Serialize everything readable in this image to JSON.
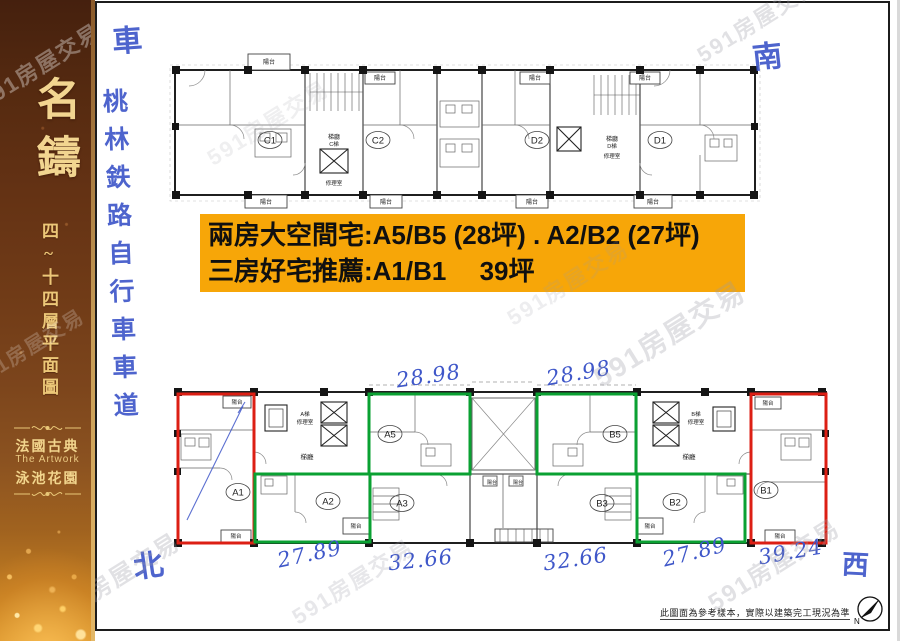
{
  "colors": {
    "orange": "#F7A608",
    "red": "#DC1F14",
    "green": "#0AA132",
    "ink": "#3F57C9",
    "gold": "#E9C878"
  },
  "watermark": "591房屋交易",
  "sidebar": {
    "title": "名鑄",
    "subtitle": "四~十四層平面圖",
    "tagline_cn": "法國古典",
    "tagline_en": "The Artwork",
    "tagline2_cn": "泳池花園"
  },
  "highlight": {
    "line1": "兩房大空間宅:A5/B5 (28坪) . A2/B2 (27坪)",
    "line2": "三房好宅推薦:A1/B1　 39坪"
  },
  "handwriting": {
    "car": "車",
    "rail": "桃林鉄路自行車車道",
    "south": "南",
    "north": "北",
    "west": "西",
    "a5_area": "28.98",
    "b5_area": "28.98",
    "a3_area": "32.66",
    "b3_area": "32.66",
    "a2_area": "27.89",
    "b2_area": "27.89",
    "b1_area": "39.24"
  },
  "plan_labels": {
    "balcony": "陽台",
    "lobby": "梯廳",
    "machine": "修理室",
    "elev_a": "A梯",
    "elev_b": "B梯",
    "elev_c": "C梯",
    "elev_d": "D梯"
  },
  "units": {
    "c1": "C1",
    "c2": "C2",
    "d2": "D2",
    "d1": "D1",
    "a1": "A1",
    "a2": "A2",
    "a3": "A3",
    "a5": "A5",
    "b1": "B1",
    "b2": "B2",
    "b3": "B3",
    "b5": "B5"
  },
  "footer": {
    "disclaimer": "此圖面為參考樣本，實際以建築完工現況為準",
    "compass_n": "N"
  }
}
